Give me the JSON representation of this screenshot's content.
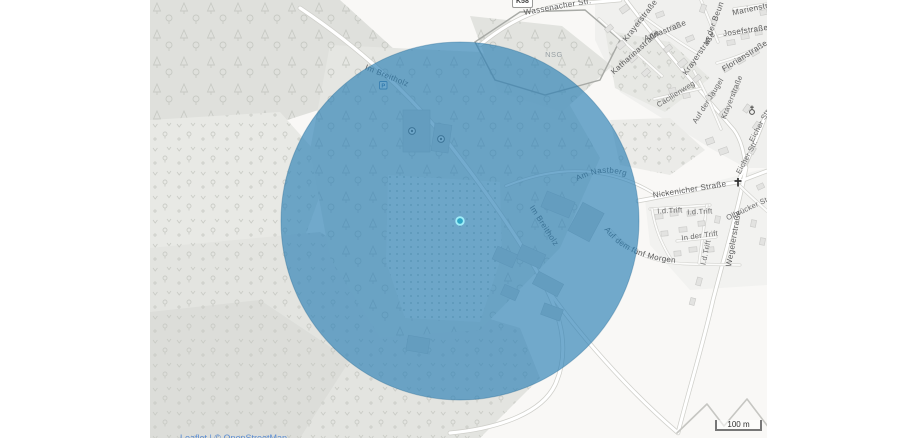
{
  "map": {
    "labels": [
      {
        "id": "wassenacher-str",
        "text": "Wassenacher Str."
      },
      {
        "id": "road-ref",
        "text": "K58"
      },
      {
        "id": "nsg",
        "text": "NSG"
      },
      {
        "id": "krayerstrasse-top",
        "text": "Krayerstraße"
      },
      {
        "id": "annastrasse",
        "text": "Annastraße"
      },
      {
        "id": "katharinastrasse",
        "text": "Katharinastraße"
      },
      {
        "id": "krayerstrasse-mid",
        "text": "Krayerstraße"
      },
      {
        "id": "in-der-beun",
        "text": "In der Beun"
      },
      {
        "id": "marienstrasse",
        "text": "Marienstraße"
      },
      {
        "id": "josefstrasse",
        "text": "Josefstraße"
      },
      {
        "id": "florianstrasse",
        "text": "Florianstraße"
      },
      {
        "id": "caecilienweg",
        "text": "Cäcilienweg"
      },
      {
        "id": "auf-der-jaugel",
        "text": "Auf der Jaugel"
      },
      {
        "id": "krayerstrasse-low",
        "text": "Krayerstraße"
      },
      {
        "id": "eicher-str-1",
        "text": "Eicher Str."
      },
      {
        "id": "eicher-str-2",
        "text": "Eicher Str."
      },
      {
        "id": "nickenicher-strasse",
        "text": "Nickenicher Straße"
      },
      {
        "id": "am-nastberg",
        "text": "Am Nastberg"
      },
      {
        "id": "id-trift-1",
        "text": "I.d.Trift"
      },
      {
        "id": "id-trift-2",
        "text": "I.d.Trift"
      },
      {
        "id": "in-der-trift",
        "text": "In der Trift"
      },
      {
        "id": "id-trift-3",
        "text": "I.d.Trift"
      },
      {
        "id": "olbruecker-str",
        "text": "Olbrücker Str."
      },
      {
        "id": "wegelerstrasse",
        "text": "Wegelerstraße"
      },
      {
        "id": "im-breitholz-1",
        "text": "Im Breitholz"
      },
      {
        "id": "im-breitholz-2",
        "text": "Im Breitholz"
      },
      {
        "id": "auf-dem-fuenf-morgen",
        "text": "Auf dem fünf Morgen"
      }
    ],
    "icons": {
      "parking_label": "P",
      "church_icon": "church",
      "cross_icon": "wayside-cross",
      "sports_icon": "sports-pitch"
    },
    "overlay": {
      "type": "radius-circle",
      "fill": "#2b7fb5",
      "fill_opacity": 0.66,
      "marker_color": "#2fa7c6",
      "marker_ring": "#9feef9"
    },
    "scale": {
      "text": "100 m"
    },
    "attribution": "Leaflet | © OpenStreetMap"
  }
}
